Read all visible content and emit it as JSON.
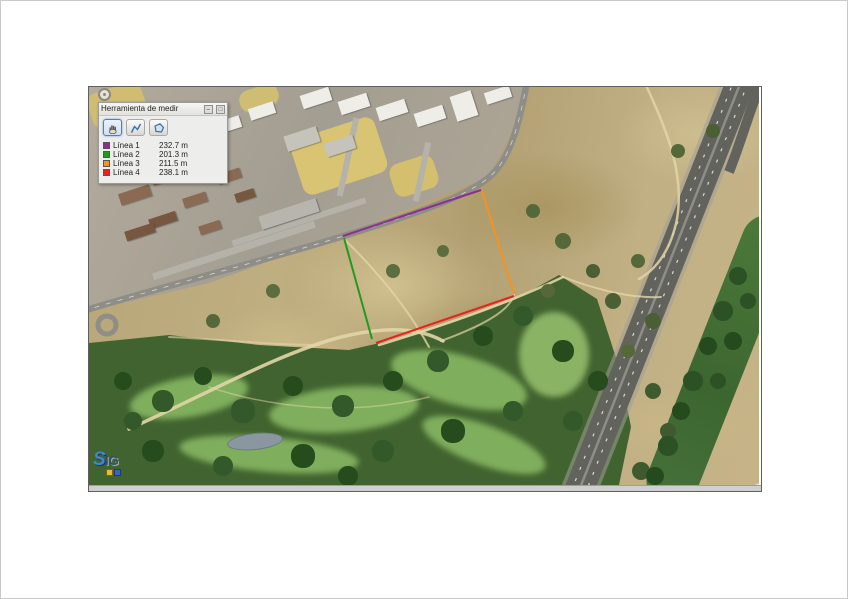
{
  "panel": {
    "title": "Herramienta de medir",
    "minimize": "–",
    "maximize": "□",
    "tools": [
      {
        "id": "navigate",
        "tooltip": "navegar"
      },
      {
        "id": "measure-line",
        "tooltip": "medir línea"
      },
      {
        "id": "measure-area",
        "tooltip": "medir polígono"
      }
    ],
    "active_tool": "navigate",
    "rows": [
      {
        "label": "Línea 1",
        "value": "232.7 m",
        "color": "#8e2f8f"
      },
      {
        "label": "Línea 2",
        "value": "201.3 m",
        "color": "#23991f"
      },
      {
        "label": "Línea 3",
        "value": "211.5 m",
        "color": "#f6921e"
      },
      {
        "label": "Línea 4",
        "value": "238.1 m",
        "color": "#e8221c"
      }
    ]
  },
  "map": {
    "logo": {
      "part1": "S",
      "part2": "IG"
    },
    "attribution": {
      "text": "PNOA ETRS - Servi. - ",
      "link": "Más información"
    },
    "measurement_lines": [
      {
        "name": "linea-1",
        "color": "#8e2f8f",
        "x1": 254,
        "y1": 149,
        "x2": 392,
        "y2": 103
      },
      {
        "name": "linea-2",
        "color": "#23991f",
        "x1": 255,
        "y1": 151,
        "x2": 283,
        "y2": 252
      },
      {
        "name": "linea-3",
        "color": "#f6921e",
        "x1": 393,
        "y1": 104,
        "x2": 425,
        "y2": 207
      },
      {
        "name": "linea-4",
        "color": "#e8221c",
        "x1": 287,
        "y1": 256,
        "x2": 425,
        "y2": 209
      }
    ]
  }
}
